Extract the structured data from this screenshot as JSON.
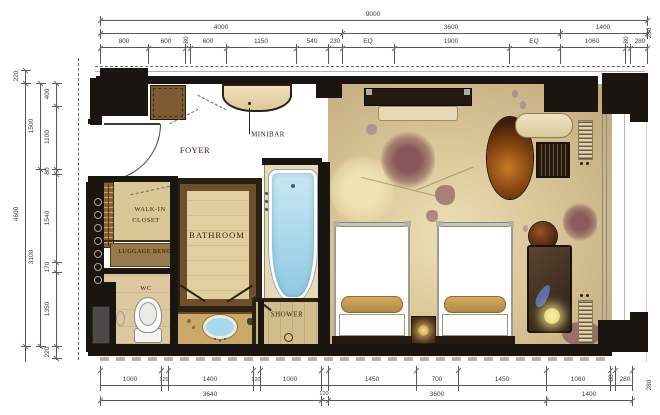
{
  "drawing": {
    "room_labels": {
      "foyer": "FOYER",
      "minibar": "MINIBAR",
      "walk_in_closet_1": "WALK-IN",
      "walk_in_closet_2": "CLOSET",
      "bathroom": "BATHROOM",
      "luggage_bench": "LUGGAGE BENCH",
      "wc": "WC",
      "shower": "SHOWER"
    },
    "dimensions": {
      "top_overall": [
        "9000"
      ],
      "top_major": [
        "4000",
        "3600",
        "1400"
      ],
      "top_detail": [
        "800",
        "600",
        "80",
        "600",
        "1150",
        "540",
        "230",
        "EQ",
        "1900",
        "EQ",
        "1060",
        "80",
        "280"
      ],
      "bottom_detail": [
        "1000",
        "120",
        "1400",
        "120",
        "1000",
        "1450",
        "700",
        "1450",
        "1060",
        "80",
        "280"
      ],
      "bottom_major": [
        "3640",
        "120",
        "3600",
        "1400"
      ],
      "left_outer": [
        "220",
        "4600"
      ],
      "left_mid": [
        "1500",
        "3100"
      ],
      "left_detail": [
        "400",
        "1100",
        "80",
        "1540",
        "170",
        "1350",
        "220"
      ],
      "right_side": [
        "280",
        "280"
      ]
    },
    "colors": {
      "wall": "#1a1510",
      "floor_foyer": "#e6d7b2",
      "floor_bath": "#e2cfa0",
      "carpet": "#cbb68a",
      "tub_water": "#a5d8ef",
      "wood": "#7d5a33",
      "bed": "#ffffff",
      "flower_accent": "#8d5f66",
      "lamp_glow": "#f5e98f"
    }
  }
}
